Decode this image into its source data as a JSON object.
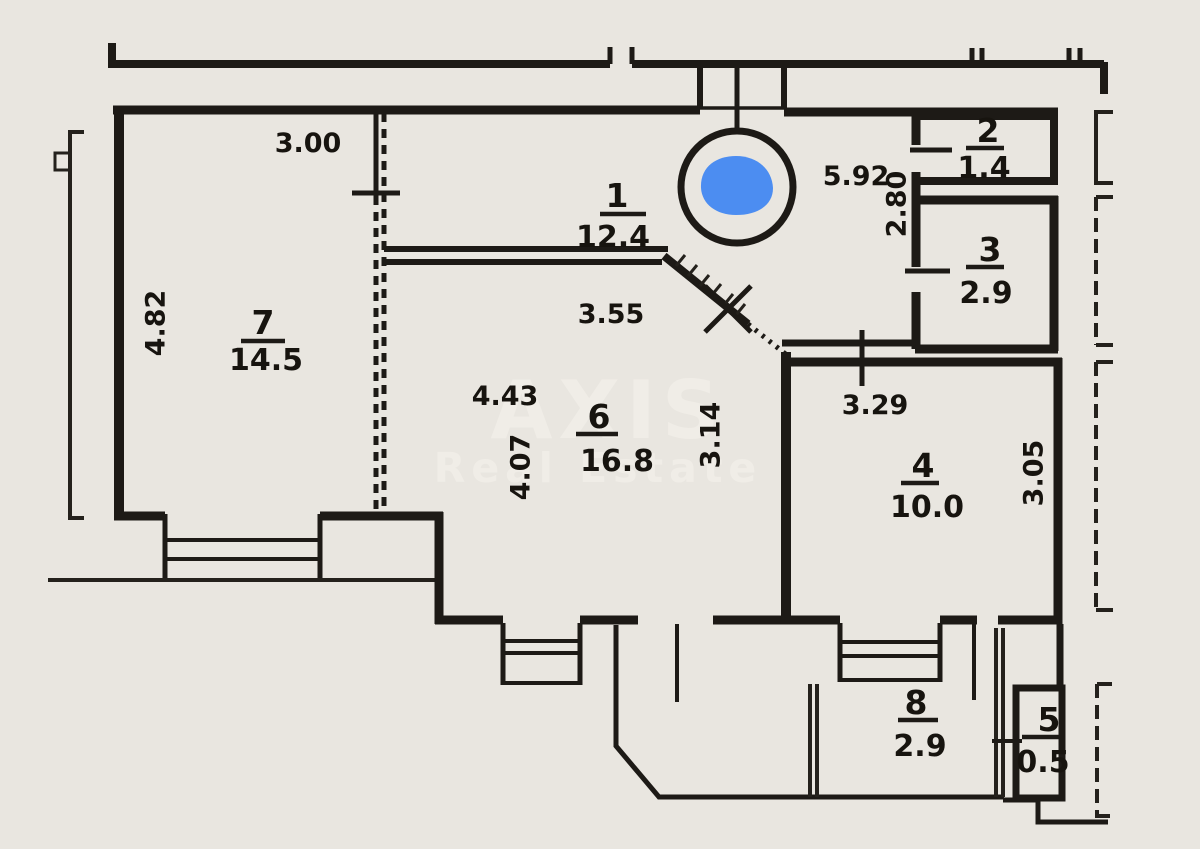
{
  "document": {
    "type": "floor-plan-scan",
    "colors": {
      "paper": "#e9e6e0",
      "ink": "#1d1a16"
    },
    "watermark": {
      "line1": "AXIS",
      "line2": "Real Estate"
    },
    "marker": {
      "label": "location-marker",
      "color": "#4c8df1"
    }
  },
  "rooms": [
    {
      "number": "1",
      "area": "12.4"
    },
    {
      "number": "2",
      "area": "1.4"
    },
    {
      "number": "3",
      "area": "2.9"
    },
    {
      "number": "4",
      "area": "10.0"
    },
    {
      "number": "5",
      "area": "0.5"
    },
    {
      "number": "6",
      "area": "16.8"
    },
    {
      "number": "7",
      "area": "14.5"
    },
    {
      "number": "8",
      "area": "2.9"
    }
  ],
  "dimensions": [
    {
      "value": "3.00",
      "orientation": "horizontal"
    },
    {
      "value": "4.82",
      "orientation": "vertical"
    },
    {
      "value": "5.92",
      "orientation": "horizontal"
    },
    {
      "value": "2.80",
      "orientation": "vertical"
    },
    {
      "value": "3.55",
      "orientation": "horizontal"
    },
    {
      "value": "4.43",
      "orientation": "horizontal"
    },
    {
      "value": "4.07",
      "orientation": "vertical"
    },
    {
      "value": "3.14",
      "orientation": "vertical"
    },
    {
      "value": "3.29",
      "orientation": "horizontal"
    },
    {
      "value": "3.05",
      "orientation": "vertical"
    }
  ]
}
